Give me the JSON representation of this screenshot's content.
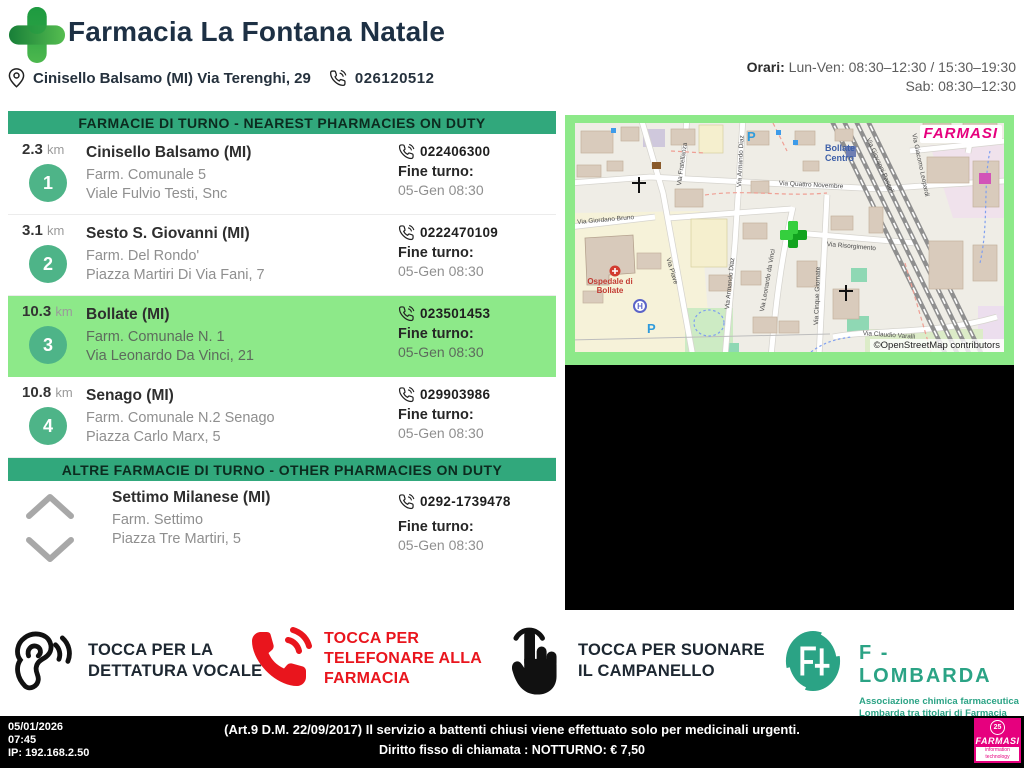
{
  "header": {
    "title": "Farmacia La Fontana Natale",
    "address": "Cinisello Balsamo (MI) Via Terenghi, 29",
    "phone": "026120512",
    "hours_label": "Orari:",
    "hours_weekdays": "Lun-Ven: 08:30–12:30 / 15:30–19:30",
    "hours_saturday": "Sab: 08:30–12:30"
  },
  "duty_section": {
    "title": "FARMACIE DI TURNO - NEAREST PHARMACIES ON DUTY",
    "shift_end_label": "Fine turno:",
    "pharmacies": [
      {
        "rank": "1",
        "distance": "2.3",
        "unit": "km",
        "city": "Cinisello Balsamo (MI)",
        "name": "Farm. Comunale 5",
        "address": "Viale Fulvio Testi, Snc",
        "phone": "022406300",
        "shift_end": "05-Gen 08:30"
      },
      {
        "rank": "2",
        "distance": "3.1",
        "unit": "km",
        "city": "Sesto S. Giovanni (MI)",
        "name": "Farm. Del Rondo'",
        "address": "Piazza Martiri Di Via Fani, 7",
        "phone": "0222470109",
        "shift_end": "05-Gen 08:30"
      },
      {
        "rank": "3",
        "distance": "10.3",
        "unit": "km",
        "city": "Bollate (MI)",
        "name": "Farm. Comunale N. 1",
        "address": "Via Leonardo Da Vinci, 21",
        "phone": "023501453",
        "shift_end": "05-Gen 08:30"
      },
      {
        "rank": "4",
        "distance": "10.8",
        "unit": "km",
        "city": "Senago (MI)",
        "name": "Farm. Comunale N.2 Senago",
        "address": "Piazza Carlo Marx, 5",
        "phone": "029903986",
        "shift_end": "05-Gen 08:30"
      }
    ]
  },
  "other_section": {
    "title": "ALTRE FARMACIE DI TURNO - OTHER PHARMACIES ON DUTY",
    "shift_end_label": "Fine turno:",
    "pharmacy": {
      "city": "Settimo Milanese (MI)",
      "name": "Farm. Settimo",
      "address": "Piazza Tre Martiri, 5",
      "phone": "0292-1739478",
      "shift_end": "05-Gen 08:30"
    }
  },
  "map": {
    "brand": "FARMASI",
    "attribution": "©OpenStreetMap contributors",
    "station_label": "Bollate Centro",
    "hospital_label": "Ospedale di Bollate",
    "parking_label": "P",
    "hospital_icon_label": "H",
    "streets": [
      "Via Quattro Novembre",
      "Via Giordano Bruno",
      "Via Piave",
      "Via Leonardo da Vinci",
      "Via Risorgimento",
      "Via Cinque Giornate",
      "Via Claudio Varalli",
      "Via Fratellanza",
      "Via Armando Diaz",
      "Via Armando Diaz",
      "Via Giovanni Pascoli",
      "Via Giacomo Leopardi"
    ]
  },
  "actions": {
    "voice": {
      "lines": [
        "TOCCA PER LA",
        "DETTATURA VOCALE"
      ]
    },
    "call": {
      "lines": [
        "TOCCA PER",
        "TELEFONARE ALLA",
        "FARMACIA"
      ]
    },
    "bell": {
      "lines": [
        "TOCCA PER SUONARE",
        "IL CAMPANELLO"
      ]
    }
  },
  "partner": {
    "name": "F - LOMBARDA",
    "subtitle1": "Associazione chimica farmaceutica",
    "subtitle2": "Lombarda tra titolari di Farmacia"
  },
  "footer": {
    "date": "05/01/2026",
    "time": "07:45",
    "ip": "IP: 192.168.2.50",
    "notice1": "(Art.9 D.M. 22/09/2017) Il servizio a battenti chiusi viene effettuato solo per medicinali urgenti.",
    "notice2": "Diritto fisso di chiamata : NOTTURNO: € 7,50",
    "brand": "FARMASI",
    "brand_badge": "25",
    "brand_sub": "information technology"
  },
  "colors": {
    "banner_green": "#31a87c",
    "highlight_green": "#8de989",
    "circle_green": "#4eb488",
    "alert_red": "#e9151d",
    "brand_magenta": "#e6007e",
    "partner_green": "#2ba385",
    "title_navy": "#1d3044"
  }
}
